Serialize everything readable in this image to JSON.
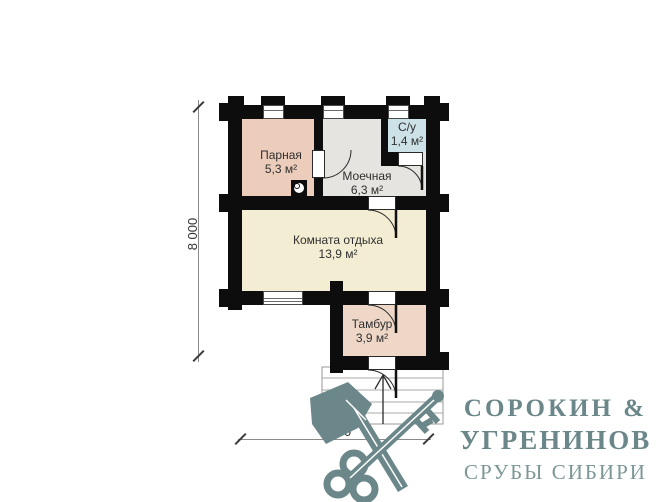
{
  "plan": {
    "rooms": [
      {
        "id": "parnaya",
        "name": "Парная",
        "area": "5,3 м²",
        "color": "#ecccba"
      },
      {
        "id": "moechnaya",
        "name": "Моечная",
        "area": "6,3 м²",
        "color": "#e5e4e0"
      },
      {
        "id": "su",
        "name": "С/у",
        "area": "1,4 м²",
        "color": "#cce2e7"
      },
      {
        "id": "komnata",
        "name": "Комната отдыха",
        "area": "13,9 м²",
        "color": "#f3edd3"
      },
      {
        "id": "tambur",
        "name": "Тамбур",
        "area": "3,9 м²",
        "color": "#eed7c7"
      }
    ],
    "dimensions": {
      "vertical": "8 000",
      "horizontal": "6 000"
    },
    "wall_color": "#0d0d0d",
    "symbols": [
      "stove-icon",
      "door-swing-arc",
      "window",
      "entrance-stairs",
      "entry-direction-arrow"
    ]
  },
  "logo": {
    "line1": "СОРОКИН &",
    "line2": "УГРЕНИНОВ",
    "line3": "СРУБЫ СИБИРИ",
    "color": "#6b8789",
    "icon": "axe-and-key"
  }
}
